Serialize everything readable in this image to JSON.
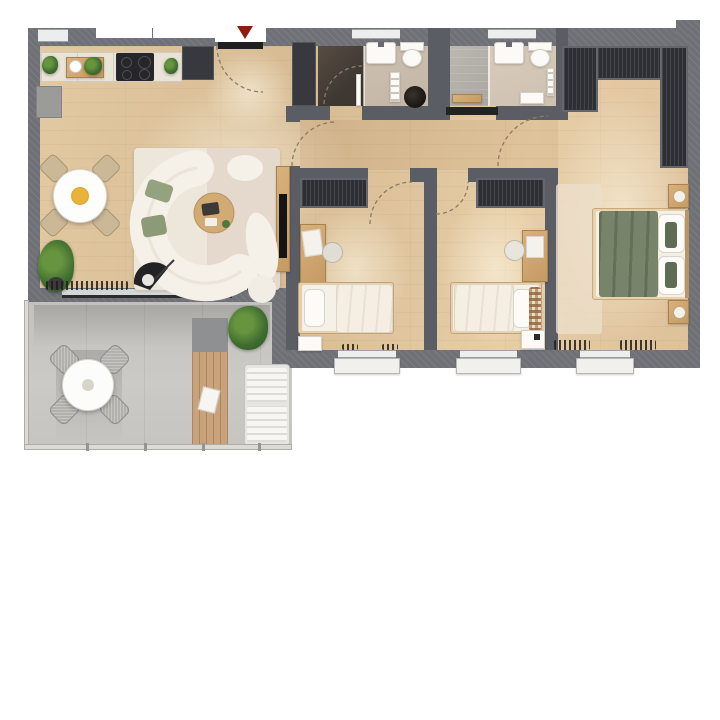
{
  "title": "apartment-floor-plan-top-view",
  "palette": {
    "wall": "#6f7177",
    "iwall": "#5a5d63",
    "wardrobe": "#2d2f34",
    "wood-floor": "#dcc19c",
    "concrete": "#c8c6c2",
    "entry-red": "#8c1d13",
    "bed-green": "#77846a",
    "pillow-green": "#5f6d55",
    "plant-green": "#4c7a3c",
    "sofa-cream": "#f5f0e8",
    "rug-cream": "#ece6db",
    "furniture-wood": "#cfa976",
    "white-fixture": "#fbfaf7"
  },
  "entry": {
    "marker": "down-arrow",
    "marker_color": "#8c1d13"
  },
  "rooms": [
    {
      "name": "kitchen-living-room",
      "floor": "wood",
      "furniture": [
        "kitchen-counter",
        "cooktop",
        "tall-cabinet",
        "low-cabinet",
        "dining-table",
        "dining-chairs",
        "curved-sofa",
        "coffee-table",
        "tv-sideboard",
        "tv",
        "armchair",
        "rug",
        "floor-plants"
      ]
    },
    {
      "name": "entry-hall",
      "floor": "wood",
      "furniture": [
        "entry-closet",
        "entry-door"
      ]
    },
    {
      "name": "bathroom-1",
      "floor": "tile",
      "furniture": [
        "dark-shower",
        "washbasin",
        "toilet",
        "towel-rack",
        "laundry-basket",
        "door"
      ]
    },
    {
      "name": "bathroom-2",
      "floor": "tile",
      "furniture": [
        "light-shower",
        "washbasin",
        "toilet",
        "towel-rail",
        "shelf",
        "bench",
        "sliding-door"
      ]
    },
    {
      "name": "hallway",
      "floor": "wood",
      "furniture": []
    },
    {
      "name": "bedroom-1",
      "floor": "wood",
      "furniture": [
        "wardrobe",
        "desk",
        "desk-chair",
        "single-bed",
        "nightstand",
        "window"
      ]
    },
    {
      "name": "bedroom-2",
      "floor": "wood",
      "furniture": [
        "wardrobe",
        "desk",
        "desk-chair",
        "single-bed",
        "plaid-blanket",
        "nightstand",
        "window"
      ]
    },
    {
      "name": "master-bedroom",
      "floor": "wood",
      "furniture": [
        "l-shaped-wardrobe",
        "double-bed",
        "green-duvet",
        "pillows",
        "nightstand-left",
        "nightstand-right",
        "rug",
        "windows"
      ]
    },
    {
      "name": "balcony",
      "floor": "concrete",
      "furniture": [
        "outdoor-round-table",
        "outdoor-chairs",
        "wood-deck",
        "sun-lounger",
        "magazine",
        "potted-plant",
        "glass-railing"
      ]
    }
  ]
}
